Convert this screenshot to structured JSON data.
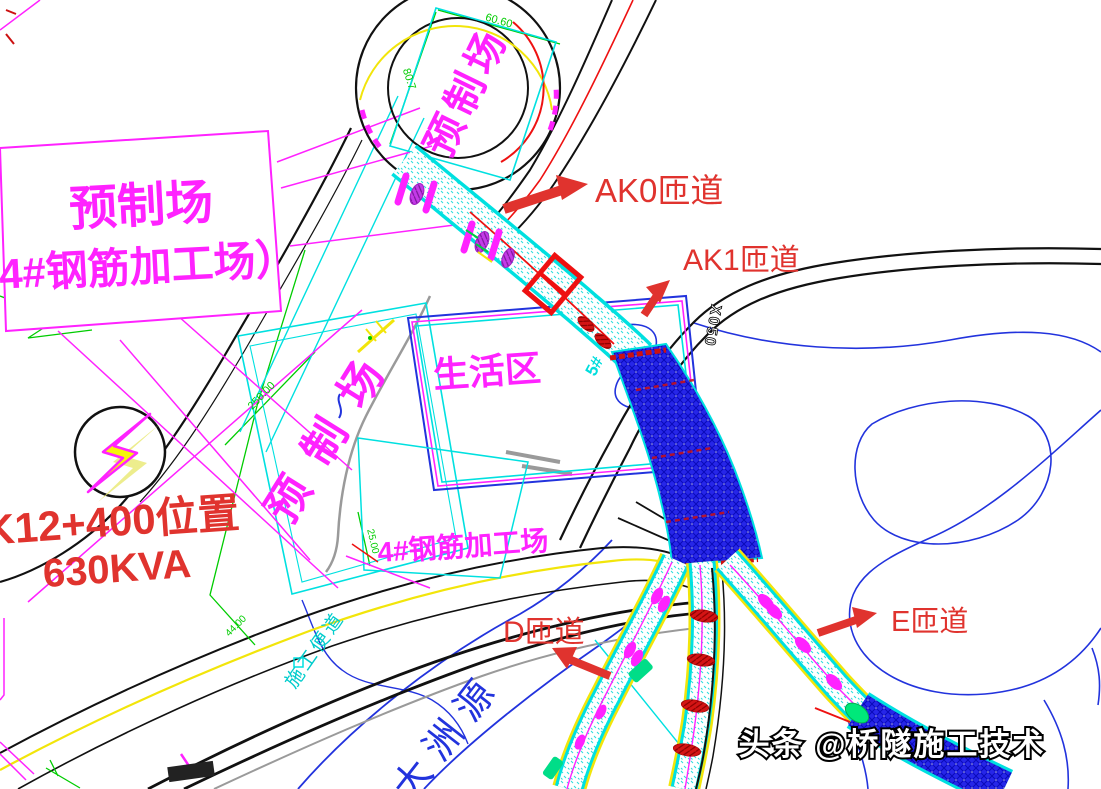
{
  "labels": {
    "yard_box": {
      "line1": "预制场",
      "line2": "（4#钢筋加工场）"
    },
    "loop_yard": "预制场",
    "precast_vertical": "预制场",
    "living_area": "生活区",
    "rebar_yard": "4#钢筋加工场",
    "power_location": {
      "line1": "K12+400位置",
      "line2": "630KVA"
    },
    "ramps": {
      "ak0": "AK0匝道",
      "ak1": "AK1匝道",
      "d": "D匝道",
      "e": "E匝道"
    },
    "river": "大洲源",
    "road_code": "X050",
    "access_road": "施工便道",
    "pier": "5#",
    "watermark": "头条 @桥隧施工技术"
  },
  "dimensions": {
    "loop_top": "60.60",
    "loop_side": "80.7",
    "yard_length": "250.00",
    "yard_width": "44.00",
    "rebar_width": "25.00"
  },
  "colors": {
    "magenta": "#ff22ff",
    "label_red": "#e0332e",
    "cad_red": "#ee1111",
    "cyan": "#00e0e0",
    "blue": "#2233dd",
    "green": "#00cc00",
    "yellow": "#f2e50a",
    "bridge_blue": "#2626e8"
  }
}
